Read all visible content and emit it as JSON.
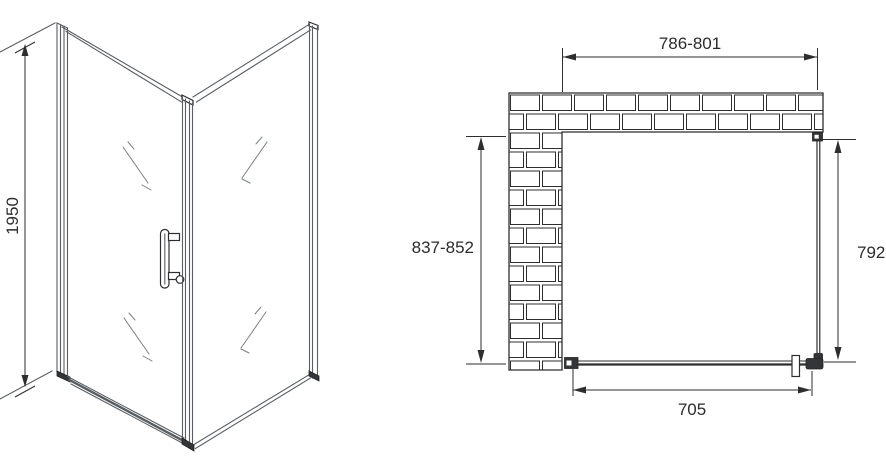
{
  "side_view": {
    "height_label": "1950"
  },
  "plan_view": {
    "top_width_label": "786-801",
    "left_depth_label": "837-852",
    "right_panel_label": "792",
    "door_width_label": "705"
  },
  "colors": {
    "main_line": "#2e2e2e",
    "frame_line": "#595e62",
    "fitting_fill": "#333538",
    "background": "#ffffff"
  }
}
